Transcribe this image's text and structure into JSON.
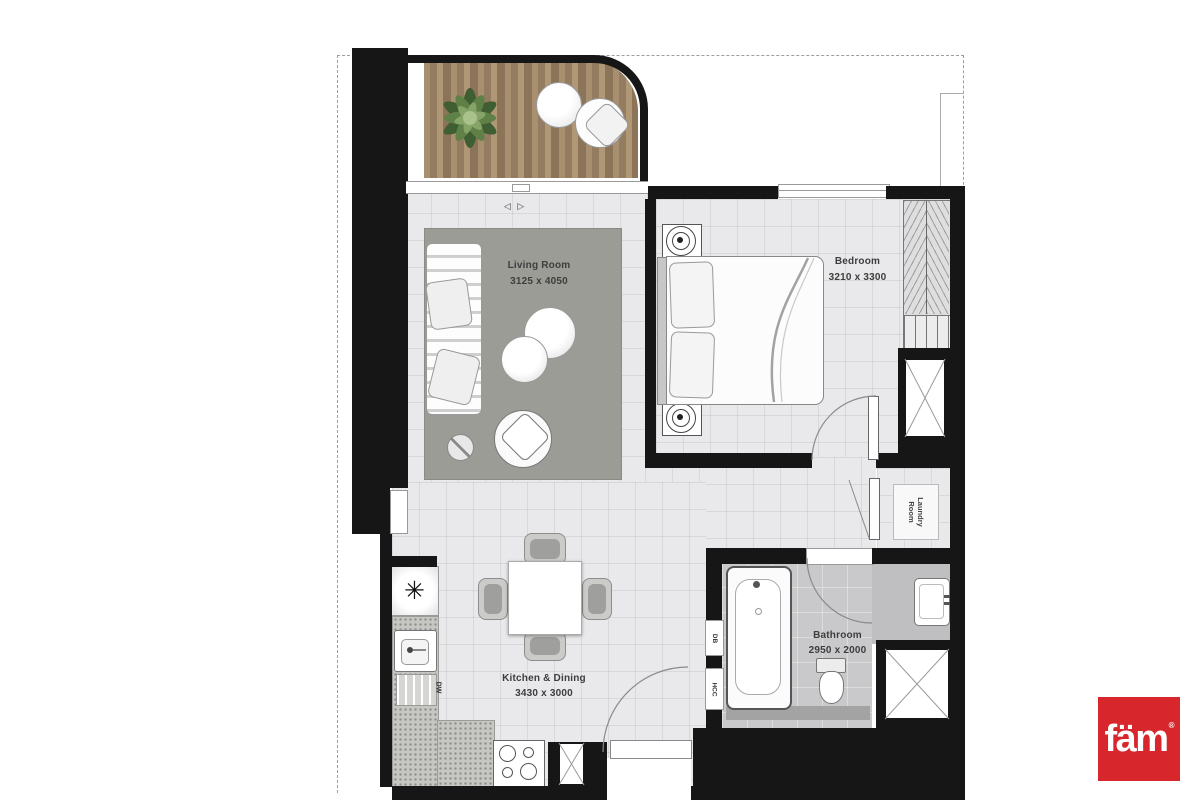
{
  "plan": {
    "rooms": {
      "living": {
        "name": "Living Room",
        "dims": "3125 x 4050"
      },
      "bedroom": {
        "name": "Bedroom",
        "dims": "3210 x 3300"
      },
      "kitchen": {
        "name": "Kitchen & Dining",
        "dims": "3430 x 3000"
      },
      "bathroom": {
        "name": "Bathroom",
        "dims": "2950 x 2000"
      },
      "laundry": {
        "line1": "Laundry",
        "line2": "Room"
      }
    },
    "annotations": {
      "dishwasher": "DW",
      "distribution_board": "DB",
      "hcc": "HCC",
      "sliding_door_symbol": "◁ ▷",
      "utility_symbol": "✳"
    },
    "colors": {
      "wall": "#161616",
      "floor_tile": "#e9e9eb",
      "rug": "#9c9c96",
      "bath_floor": "#c9c9cb",
      "balcony_deck": "#9a8264"
    }
  },
  "branding": {
    "logo_text": "fäm",
    "registered_mark": "®",
    "logo_bg": "#D7262C"
  }
}
